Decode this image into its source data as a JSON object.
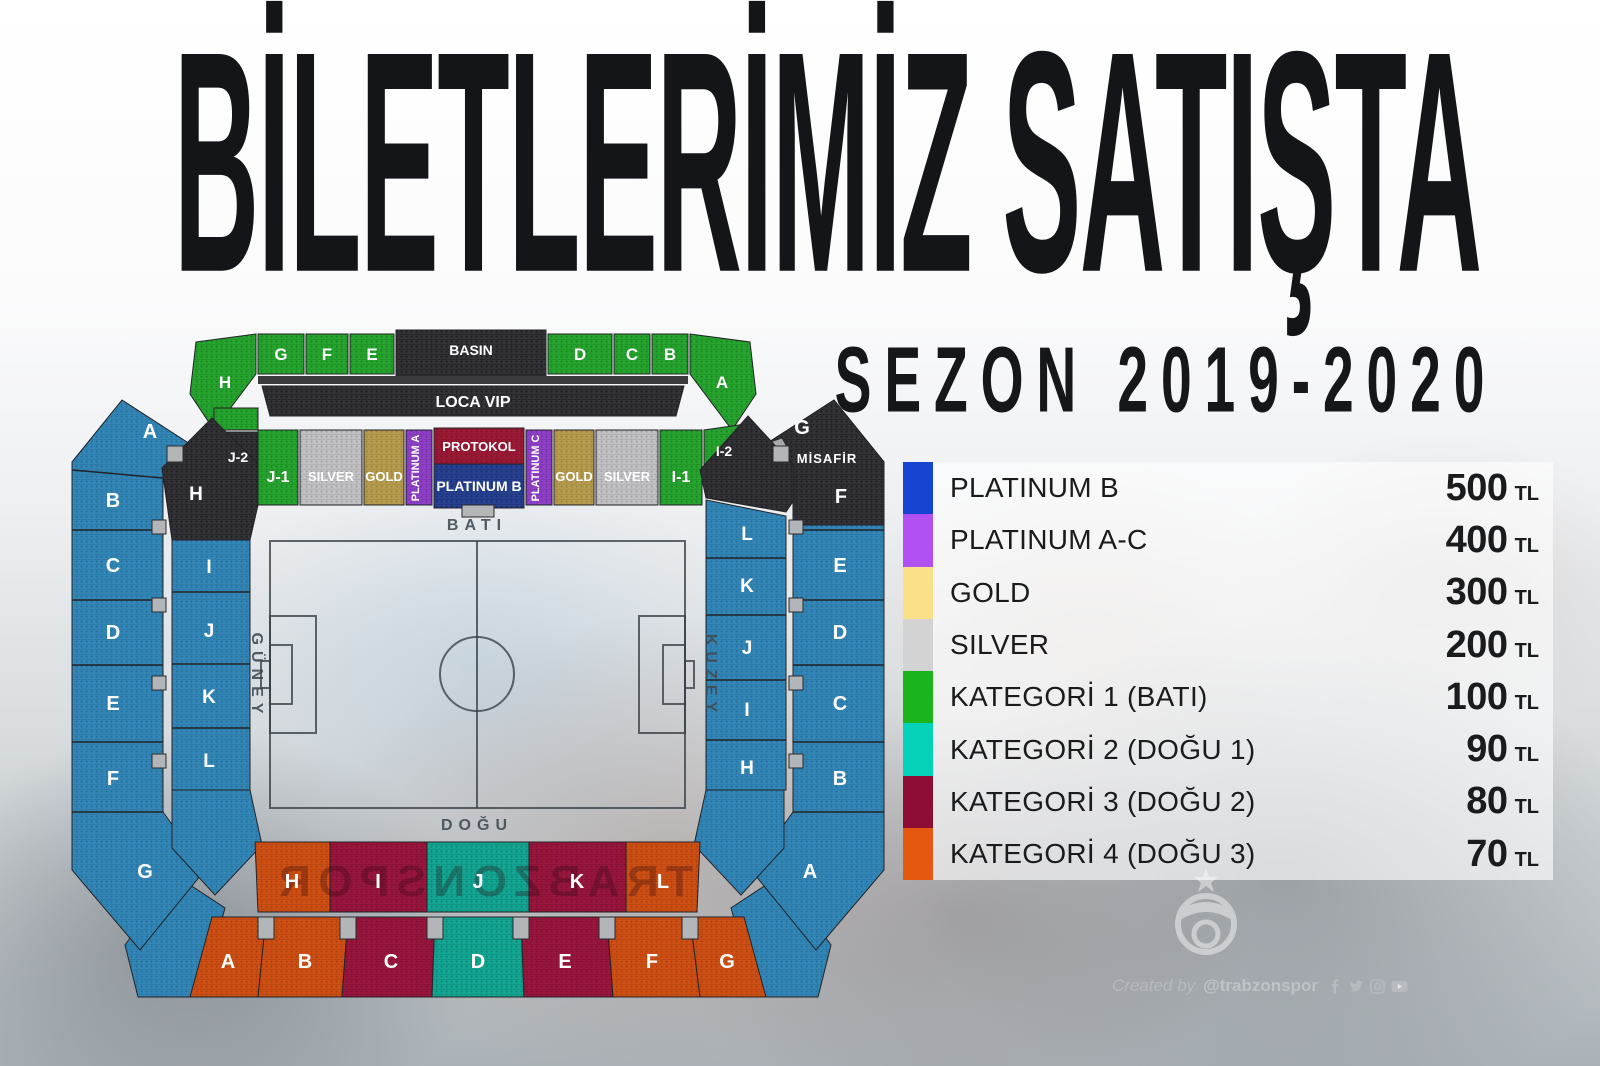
{
  "title": "BİLETLERİMİZ SATIŞTA",
  "subtitle": "SEZON 2019-2020",
  "legend": {
    "rows": [
      {
        "label": "PLATINUM B",
        "price": "500",
        "currency": "TL",
        "color": "#1544d0"
      },
      {
        "label": "PLATINUM A-C",
        "price": "400",
        "currency": "TL",
        "color": "#b251f1"
      },
      {
        "label": "GOLD",
        "price": "300",
        "currency": "TL",
        "color": "#fbe08a"
      },
      {
        "label": "SILVER",
        "price": "200",
        "currency": "TL",
        "color": "#d3d3d3"
      },
      {
        "label": "KATEGORİ 1 (BATI)",
        "price": "100",
        "currency": "TL",
        "color": "#1cb41c"
      },
      {
        "label": "KATEGORİ 2 (DOĞU 1)",
        "price": "90",
        "currency": "TL",
        "color": "#03d2b8"
      },
      {
        "label": "KATEGORİ 3 (DOĞU 2)",
        "price": "80",
        "currency": "TL",
        "color": "#8d0d34"
      },
      {
        "label": "KATEGORİ 4 (DOĞU 3)",
        "price": "70",
        "currency": "TL",
        "color": "#e55810"
      }
    ]
  },
  "stadium": {
    "directions": {
      "west": "BATI",
      "east": "DOĞU",
      "south": "GÜNEY",
      "north": "KUZEY"
    },
    "press_box": "BASIN",
    "loca_vip": "LOCA VIP",
    "away_label": "MİSAFİR",
    "watermark": "TRABZONSPOR",
    "west_upper": [
      "H",
      "G",
      "F",
      "E",
      "D",
      "C",
      "B",
      "A"
    ],
    "west_lower": [
      "J-2",
      "J-1",
      "SILVER",
      "GOLD",
      "PLATINUM A",
      "PROTOKOL",
      "PLATINUM B",
      "PLATINUM C",
      "GOLD",
      "SILVER",
      "I-1",
      "I-2"
    ],
    "south_outer": [
      "A",
      "B",
      "C",
      "D",
      "E",
      "F",
      "G"
    ],
    "south_inner": [
      "H",
      "I",
      "J",
      "K",
      "L"
    ],
    "north_outer": [
      "G",
      "F",
      "E",
      "D",
      "C",
      "B",
      "A"
    ],
    "north_inner": [
      "L",
      "K",
      "J",
      "I",
      "H"
    ],
    "east_inner": [
      "H",
      "I",
      "J",
      "K",
      "L"
    ],
    "east_outer": [
      "A",
      "B",
      "C",
      "D",
      "E",
      "F",
      "G"
    ],
    "map_colors": {
      "green": "#27a52f",
      "blue": "#3387b8",
      "black": "#333338",
      "silver": "#c3c3c5",
      "gold": "#b89d50",
      "purple": "#9040c8",
      "navy": "#284293",
      "crimson": "#9d1a37",
      "orange": "#d05014",
      "maroon": "#9a163e",
      "teal": "#13a794"
    }
  },
  "footer": {
    "credit": "Created by",
    "handle": "@trabzonspor",
    "icons": [
      "facebook-icon",
      "twitter-icon",
      "instagram-icon",
      "youtube-icon"
    ]
  }
}
